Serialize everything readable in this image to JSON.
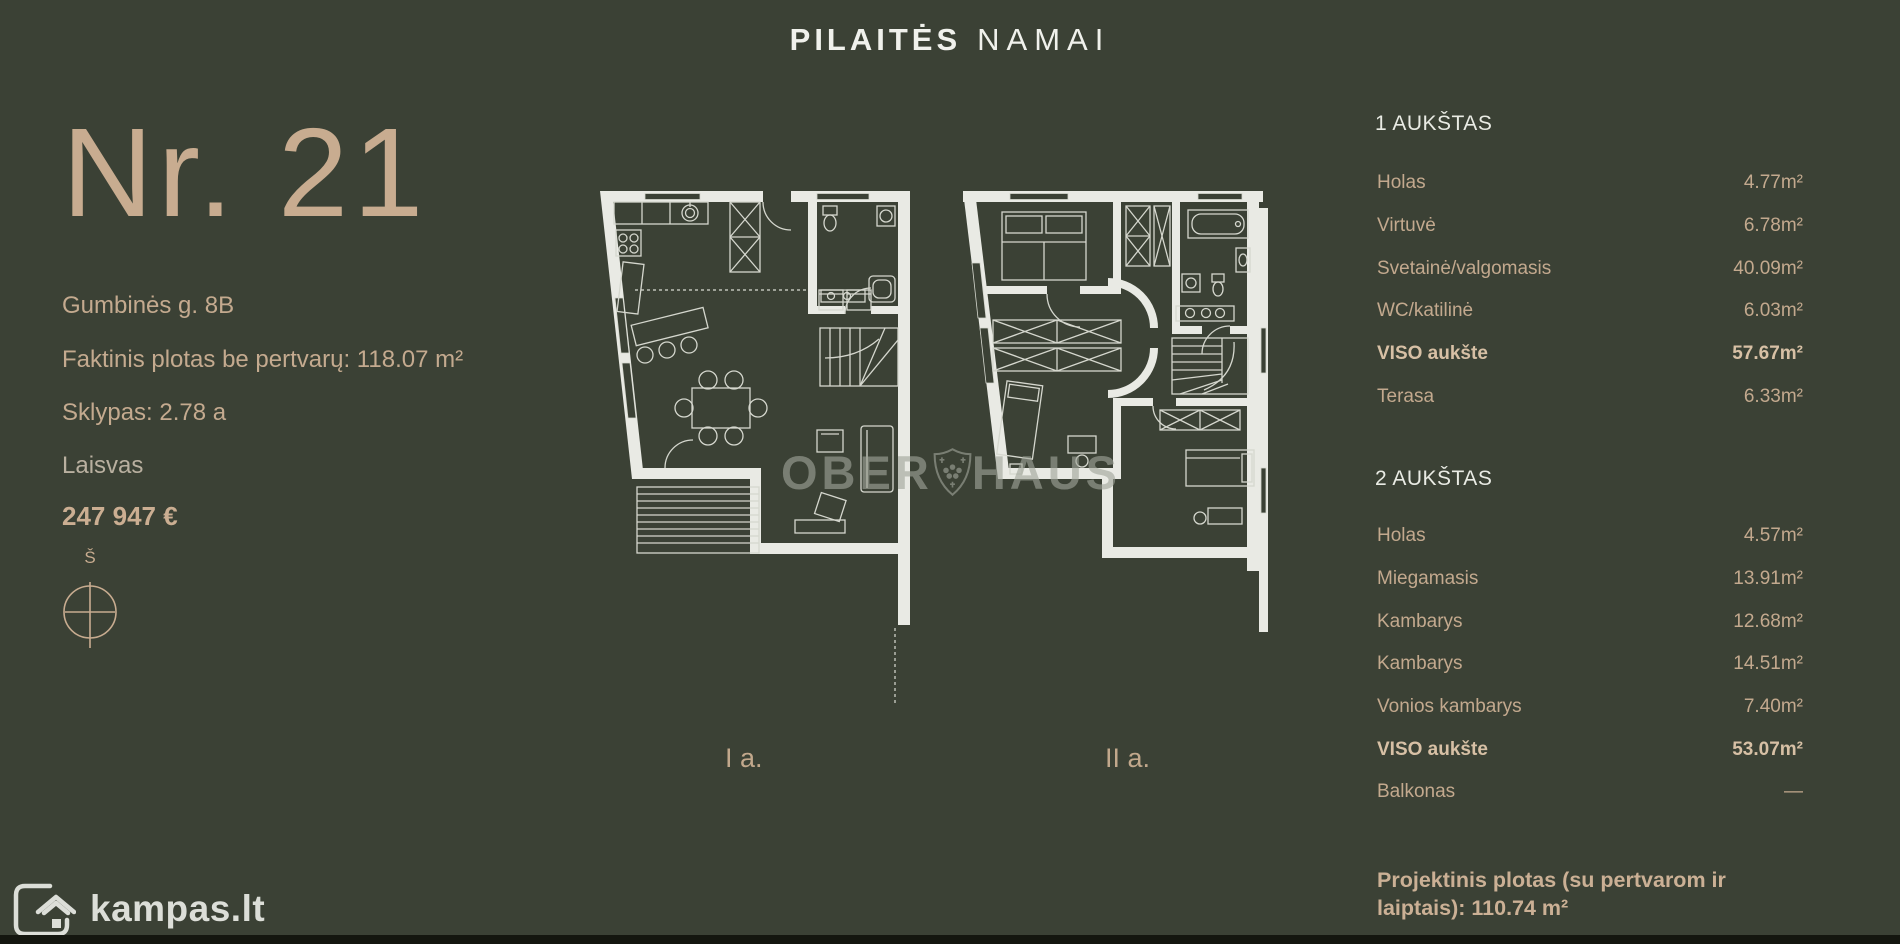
{
  "brand": {
    "primary": "PILAITĖS",
    "secondary": "NAMAI"
  },
  "listing": {
    "number": "Nr. 21",
    "address": "Gumbinės g. 8B",
    "area": "Faktinis plotas be pertvarų: 118.07 m²",
    "plot": "Sklypas: 2.78 a",
    "status": "Laisvas",
    "price": "247 947 €",
    "compass": "Š"
  },
  "plans": {
    "first_floor_label": "I a.",
    "second_floor_label": "II a.",
    "watermark_left": "OBER",
    "watermark_right": "HAUS"
  },
  "floor1": {
    "title": "1 AUKŠTAS",
    "rows": [
      {
        "label": "Holas",
        "value": "4.77m²"
      },
      {
        "label": "Virtuvė",
        "value": "6.78m²"
      },
      {
        "label": "Svetainė/valgomasis",
        "value": "40.09m²"
      },
      {
        "label": "WC/katilinė",
        "value": "6.03m²"
      },
      {
        "label": "VISO aukšte",
        "value": "57.67m²"
      },
      {
        "label": "Terasa",
        "value": "6.33m²"
      }
    ]
  },
  "floor2": {
    "title": "2 AUKŠTAS",
    "rows": [
      {
        "label": "Holas",
        "value": "4.57m²"
      },
      {
        "label": "Miegamasis",
        "value": "13.91m²"
      },
      {
        "label": "Kambarys",
        "value": "12.68m²"
      },
      {
        "label": "Kambarys",
        "value": "14.51m²"
      },
      {
        "label": "Vonios kambarys",
        "value": "7.40m²"
      },
      {
        "label": "VISO aukšte",
        "value": "53.07m²"
      },
      {
        "label": "Balkonas",
        "value": "—"
      }
    ]
  },
  "summary": "Projektinis plotas (su pertvarom ir laiptais): 110.74 m²",
  "site": {
    "logo_text": "kampas.lt"
  },
  "colors": {
    "background": "#3b4135",
    "accent_tan": "#c7ab8f",
    "heading_white": "#edeeea",
    "wall_white": "#e9eae4",
    "watermark_gray": "#9aa095",
    "footer_strip": "#14160f"
  }
}
